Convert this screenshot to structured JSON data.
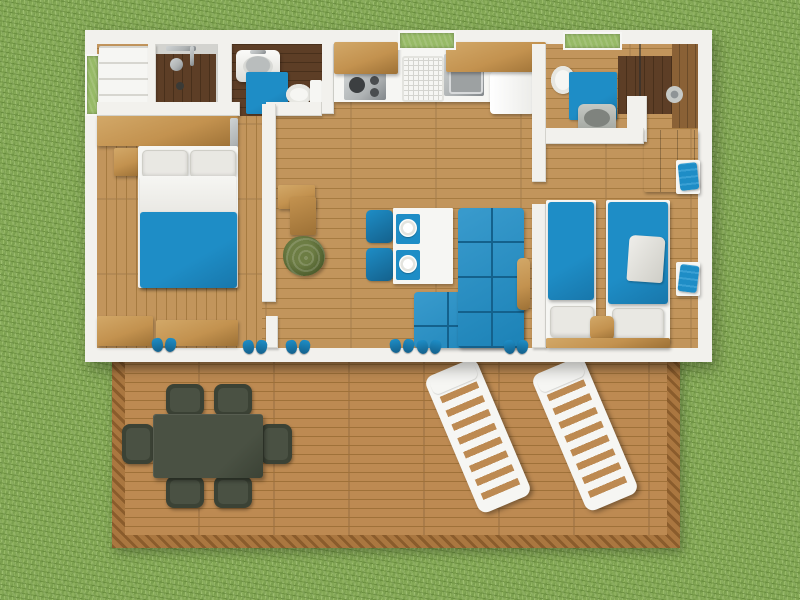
{
  "meta": {
    "type": "3d-floor-plan-render",
    "view": "top-down",
    "subject": "Two-bedroom holiday mobile home with terrace deck on grass",
    "canvas_width": 800,
    "canvas_height": 600
  },
  "colors": {
    "grass": "#83a755",
    "grass-dk": "#6f9343",
    "grass-lt": "#97ba67",
    "wall": "#f2f1ed",
    "wall-sh": "#d7d6d0",
    "floor": "#c2955c",
    "floor-seam": "#a67b41",
    "floor-dk": "#5d3e26",
    "floor-dk-seam": "#49301b",
    "wood-mid": "#8a6136",
    "deck": "#bd8a52",
    "deck-seam": "#9f7139",
    "trim": "#aa7740",
    "trim-dk": "#8a5c2c",
    "blue": "#1e8dc6",
    "blue-dk": "#14618c",
    "wood": "#c3924f",
    "wood-dk": "#9d7136",
    "wood-lt": "#d2a868",
    "white": "#f6f6f3",
    "linen": "#e9e8e3",
    "linen-sh": "#cfcec7",
    "steel": "#aeb2b3",
    "steel-dk": "#82878a",
    "out": "#4a5143",
    "out-dk": "#3b4235",
    "plant": "#6d7d44",
    "plant-dk": "#4c5c2c"
  },
  "rooms": [
    {
      "id": "bedroom-double",
      "name": "Double bedroom"
    },
    {
      "id": "shower-room",
      "name": "Shower room"
    },
    {
      "id": "wc",
      "name": "WC"
    },
    {
      "id": "kitchen-living",
      "name": "Kitchen and living area"
    },
    {
      "id": "hallway",
      "name": "Hallway"
    },
    {
      "id": "bathroom-second",
      "name": "Second bathroom"
    },
    {
      "id": "bedroom-twin",
      "name": "Twin bedroom"
    },
    {
      "id": "terrace",
      "name": "Terrace deck"
    }
  ],
  "furniture": {
    "double_bed": "Double bed",
    "single_bed_left": "Single bed (left)",
    "single_bed_right": "Single bed (right)",
    "headboard": "Headboard shelf",
    "nightstand": "Nightstand",
    "bench": "Storage bench",
    "wardrobe": "Wardrobe",
    "closet": "Shelving closet",
    "shower": "Shower",
    "washbasin": "Washbasin",
    "toilet": "Toilet",
    "bath_mat": "Blue bath mat",
    "kitchen_counter": "Kitchen counter",
    "hob": "Gas hob",
    "kitchen_sink": "Kitchen sink",
    "dish_rack": "Dish rack",
    "fridge": "Fridge",
    "upper_cabinet": "Upper cabinet",
    "dining_table": "Dining table with place settings",
    "dining_chair": "Dining chair",
    "sofa": "Blue corner sofa",
    "side_cabinet": "Side cabinet",
    "plant": "Potted plant",
    "towel": "Blue towel",
    "clothes": "Folded clothes",
    "slippers": "Slippers",
    "outdoor_table": "Garden dining table",
    "outdoor_chair": "Garden chair",
    "sun_lounger": "Sun lounger",
    "window": "Window"
  }
}
